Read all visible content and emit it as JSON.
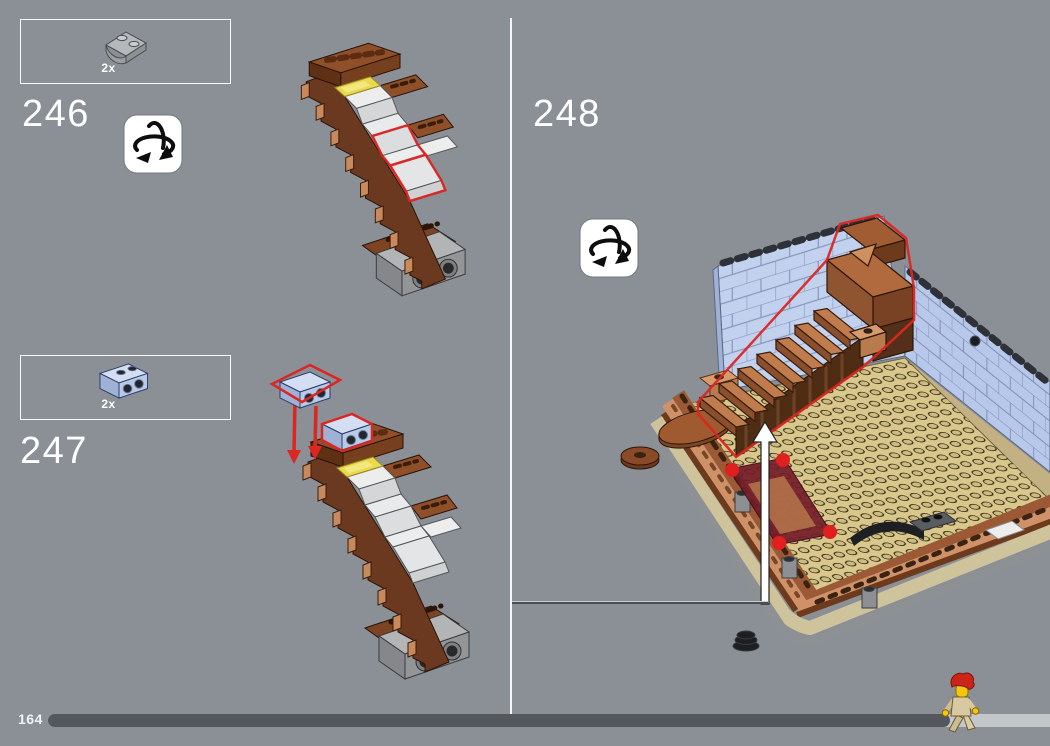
{
  "steps": [
    {
      "label": "246",
      "part_qty": "2x",
      "part_name": "light-gray-2x2-curved-slope-plate",
      "rotate_icon": true
    },
    {
      "label": "247",
      "part_qty": "2x",
      "part_name": "light-blue-1x2-brick-with-side-studs",
      "rotate_icon": false
    },
    {
      "label": "248",
      "rotate_icon": true
    }
  ],
  "footer": {
    "page_label": "164",
    "progress_percent": 90
  },
  "colors": {
    "background": "#8A9096",
    "divider": "#FFFFFF",
    "highlight_red": "#DC2622",
    "brick_brown": "#8F4F28",
    "wall_blue": "#C2D1EE",
    "floor_tan": "#D9C78C",
    "trans_yellow": "#E9D94F",
    "progress_fill": "#54585C",
    "progress_track": "#C3C7CA",
    "step_text": "#FFFFFF"
  }
}
